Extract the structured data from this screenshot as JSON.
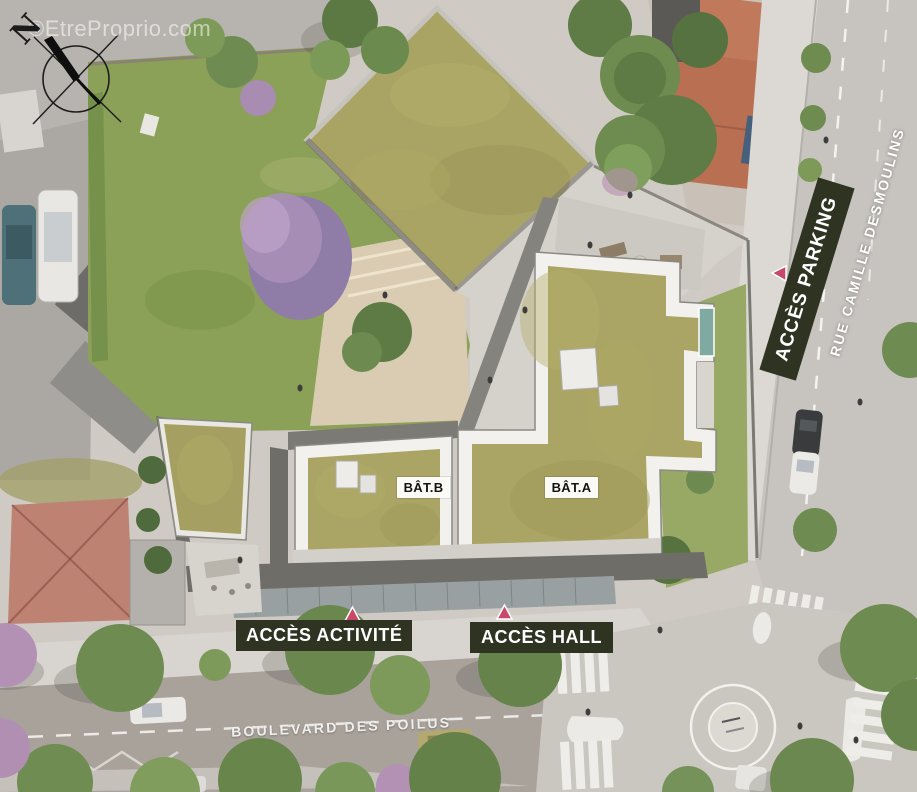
{
  "labels": {
    "watermark": "©EtreProprio.com",
    "compass_north": "N",
    "acces_parking": "ACCÈS PARKING",
    "acces_activite": "ACCÈS ACTIVITÉ",
    "acces_hall": "ACCÈS HALL",
    "bat_a": "BÂT.A",
    "bat_b": "BÂT.B",
    "rue_camille_desmoulins": "RUE CAMILLE DESMOULINS",
    "boulevard_des_poilus": "BOULEVARD DES POILUS"
  },
  "colors": {
    "access_label_bg": "#2f3322",
    "access_label_text": "#ffffff",
    "building_label_bg": "#fbfaf6",
    "building_label_text": "#141414",
    "marker_triangle": "#c9486a",
    "green_roof": "#a9a364",
    "lawn": "#8ba157",
    "road_right": "#c7c3bf",
    "road_boulevard": "#a8a29b",
    "white_parapet": "#f2f1ed"
  }
}
